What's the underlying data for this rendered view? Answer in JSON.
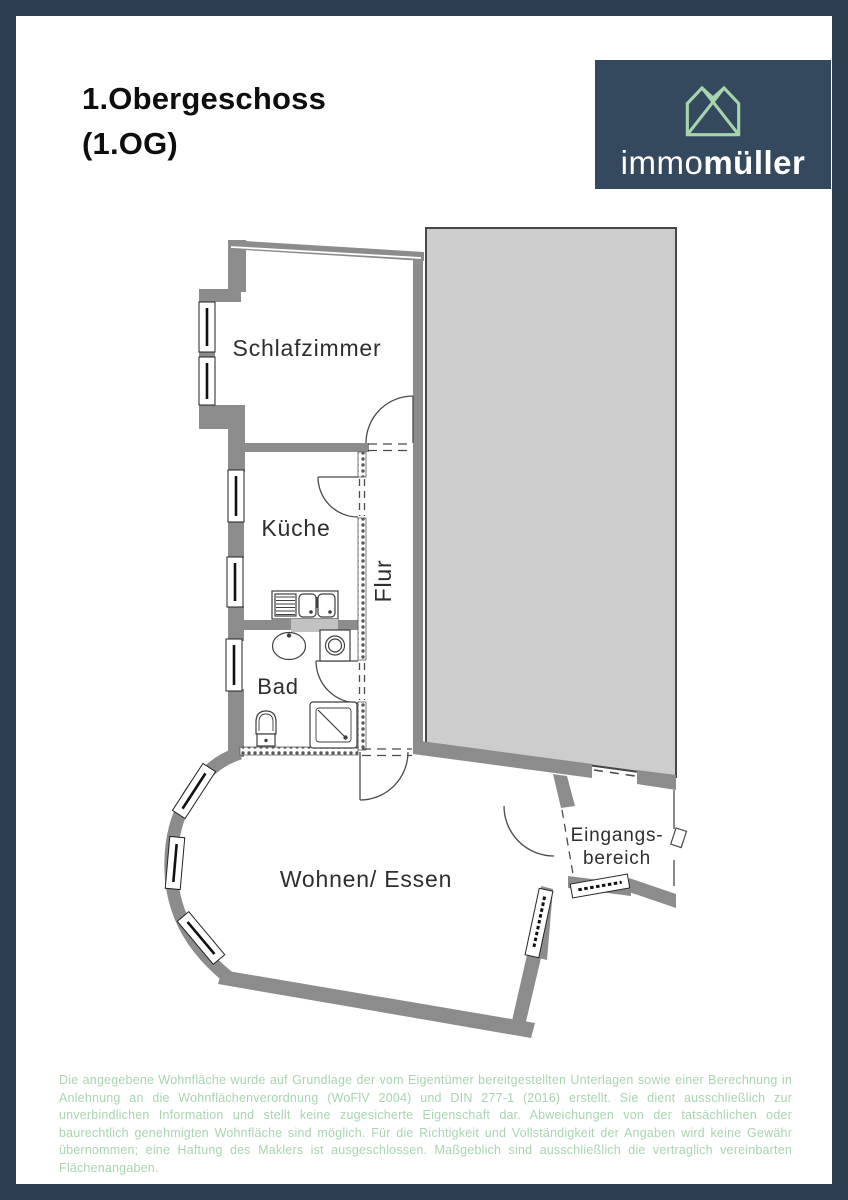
{
  "header": {
    "title_line1": "1.Obergeschoss",
    "title_line2": "(1.OG)"
  },
  "logo": {
    "brand_light": "immo",
    "brand_bold": "müller",
    "icon": "house-gables-icon"
  },
  "floorplan": {
    "rooms": {
      "bedroom": "Schlafzimmer",
      "kitchen": "Küche",
      "hall": "Flur",
      "bath": "Bad",
      "living": "Wohnen/ Essen",
      "entrance_line1": "Eingangs-",
      "entrance_line2": "bereich"
    }
  },
  "disclaimer": {
    "text": "Die angegebene Wohnfläche wurde auf Grundlage der vom Eigentümer bereitgestellten Unterlagen sowie einer Berechnung in Anlehnung an die Wohnflächenverordnung (WoFlV 2004) und DIN 277-1 (2016) erstellt. Sie dient ausschließlich zur unverbindlichen Information und stellt keine zugesicherte Eigenschaft dar. Abweichungen von der tatsächlichen oder baurechtlich genehmigten Wohnfläche sind möglich. Für die Richtigkeit und Vollständigkeit der Angaben wird keine Gewähr übernommen; eine Haftung des Maklers ist ausgeschlossen. Maßgeblich sind ausschließlich die vertraglich vereinbarten Flächenangaben."
  },
  "colors": {
    "frame": "#2d3e53",
    "logo_bg": "#34495d",
    "logo_icon_green": "#a6d4ac",
    "wall_gray": "#8c8c8c",
    "adjacent_building_fill": "#cdcdce",
    "adjacent_building_stroke": "#474747",
    "disclaimer_green": "#a8d5b0",
    "plan_line": "#4a4a4a"
  }
}
